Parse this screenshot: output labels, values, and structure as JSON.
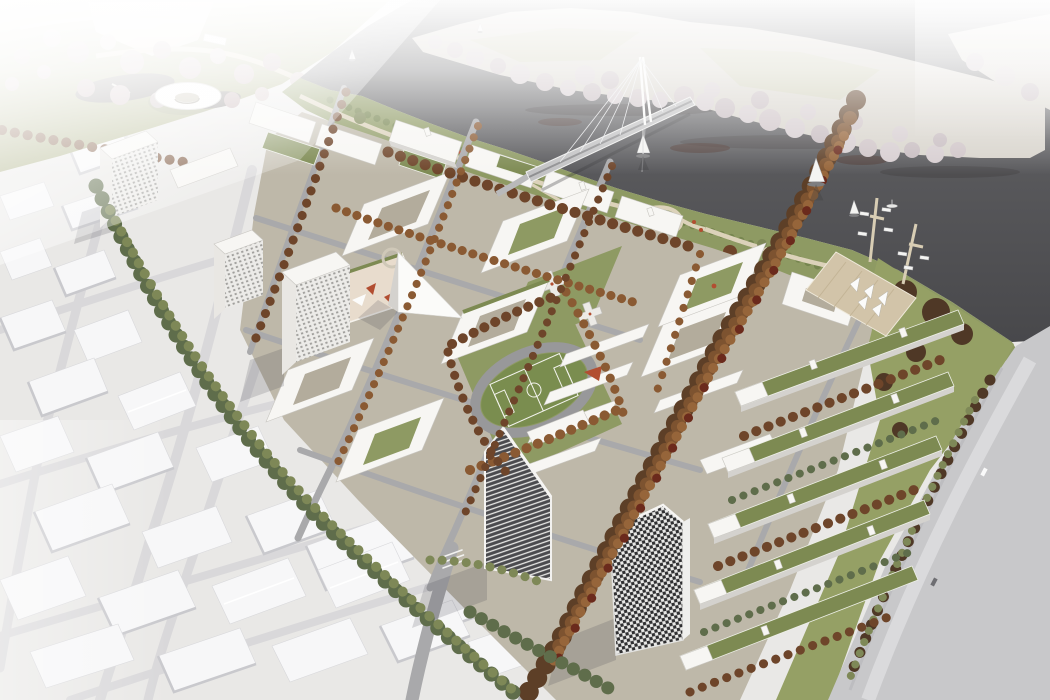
{
  "meta": {
    "kind": "architectural aerial rendering",
    "description": "Bird's-eye render of a new riverfront urban district: white perimeter housing blocks with green roofs, autumn tree boulevards, a stadium lawn with running track and soccer pitch, two dark landmark towers, a cable-stayed pedestrian bridge to wooded islands, a marina with piers and sail canopies, and a monochrome white context city fading into mist."
  },
  "palette": {
    "mist": "#ffffff",
    "land": "#e9e8e6",
    "water": "#58585b",
    "island": "#d7d3cb",
    "tree_pale": "#d6cdd0",
    "tree_pink": "#c2adaf",
    "tree_orange": "#8a5a33",
    "tree_rust": "#6e452a",
    "tree_dark": "#4f3826",
    "tree_green": "#5f6d4b",
    "tree_olive": "#7e8857",
    "lawn": "#8e9a63",
    "pitch": "#7a8d4f",
    "track": "#98989a",
    "sand": "#e5dfd1",
    "path": "#dcd2ba",
    "red_accent": "#b24e31",
    "deck": "#d2c4a9",
    "road": "#a9a9ab",
    "context_road": "#d9d8da",
    "highway": "#c8c8ca",
    "district_ground": "#beb8a9",
    "bldg_roof": "#f7f6f3",
    "bldg_wall": "#e9e7e3",
    "bldg_shade": "#d4d2ce",
    "context_roof": "#f7f7f8",
    "context_wall": "#c9c9cd",
    "green_roof": "#7d8a52",
    "tower_dark": "#45454a",
    "tower_frame": "#f2f1ef",
    "checker_dark": "#2f2f31",
    "pond": "#6b6764",
    "shadow": "#3c3c46",
    "court": "#b3ac9c",
    "cream": "#e8dccd"
  },
  "scene": {
    "river": {
      "label": "dark river across upper right",
      "boats_sailing": 6
    },
    "islands": {
      "label": "gravel islands with pale autumn trees",
      "count": 2
    },
    "bridge": {
      "label": "cable-stayed pedestrian bridge with single white pylon"
    },
    "park": {
      "label": "misty park with mauve trees, pond and white ring pavilion"
    },
    "sports": {
      "label": "lawn block with grey running track and soccer pitch"
    },
    "towers": {
      "label": "striped wedge-top tower and black-white checkered tower"
    },
    "housing": {
      "label": "white perimeter blocks, courtyards, green roofs, red accents"
    },
    "slab_rows": {
      "label": "five green-roof slab rows toward highway",
      "count": 5
    },
    "marina": {
      "label": "timber deck with white sail canopies, two piers, moored boats"
    },
    "highway": {
      "label": "wide grey highway along right edge"
    },
    "context_city": {
      "label": "untextured white massing model of existing city"
    },
    "mist": {
      "label": "white fog veil at top and far corners"
    }
  }
}
